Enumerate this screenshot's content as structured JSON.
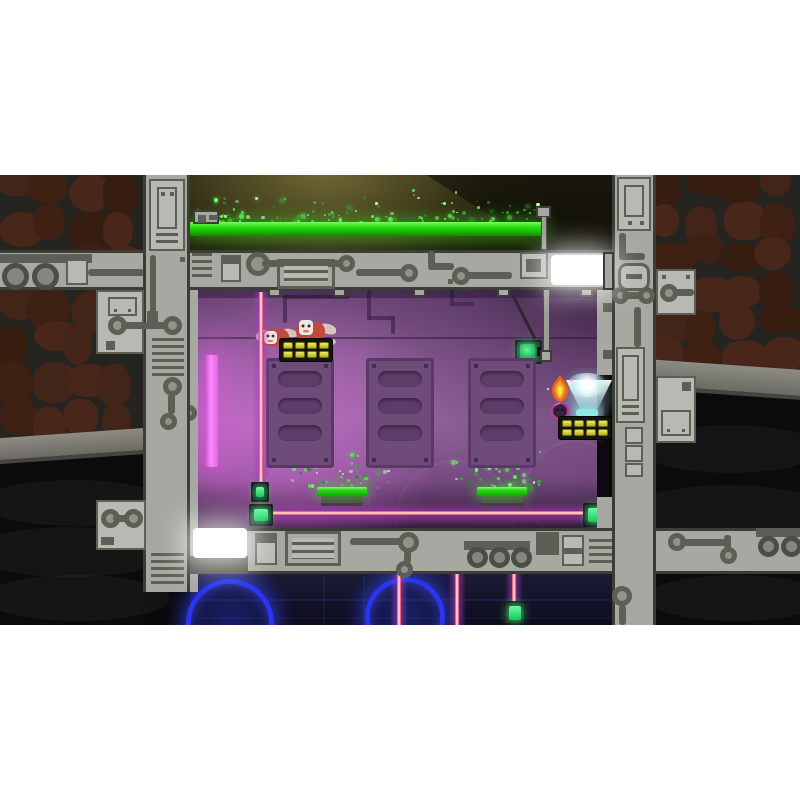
{
  "meta": {
    "app": "2d-platformer-game-screenshot",
    "scene_name": "purple-lab-room",
    "visible_text": "none",
    "letterbox_color": "#ffffff"
  },
  "palette": {
    "frame": "#a6a8a1",
    "frame_light": "#b7b9b2",
    "frame_dark": "#3b3d37",
    "trace": "#5c5f55",
    "rock": "#3f2113",
    "rock_bg": "#262421",
    "cave_black": "#0b0b0b",
    "ledge": "#82817a",
    "grass": "#22d512",
    "grass_hi": "#62f14c",
    "grass_dark": "#0e9b06",
    "cabinet": "#6f4b79",
    "cabinet_dark": "#593a66",
    "magenta": "#e865ea",
    "laser_red": "#e23b52",
    "laser_glow": "rgba(168,58,188,0.5)",
    "yellow": "#d8d435",
    "yellow_hi": "#f0ec6e",
    "block_bg": "#15150c",
    "emit_green": "#2fe56e",
    "beacon": "#9ef2ea",
    "ring_blue": "#2a35f0",
    "flame1": "#e4661c",
    "flame2": "#f59d22",
    "flame3": "#fbe049",
    "ball": "#35223c",
    "ball_rim": "#bb3aa0",
    "critter": "#c24840",
    "critter_face": "#ece7e2",
    "wing": "#d6c4be",
    "white_lamp": "#ffffff"
  },
  "scene": {
    "top": {
      "grass_platform": {
        "x": 190,
        "y": 47,
        "w": 355,
        "h": 14
      },
      "pole": {
        "x": 541,
        "y": 41,
        "w": 6,
        "h": 34,
        "cap_x": 536,
        "cap_y": 31,
        "cap_w": 15,
        "cap_h": 12
      },
      "machine": {
        "x": 193,
        "y": 35,
        "w": 26,
        "h": 14
      },
      "particles": [
        {
          "x": 192,
          "y": 12,
          "w": 350,
          "h": 36,
          "count": 130,
          "seed": 11,
          "bias": 2.4
        },
        {
          "x": 196,
          "y": 34,
          "w": 34,
          "h": 12,
          "count": 14,
          "seed": 4,
          "bias": 1.2
        }
      ]
    },
    "room": {
      "cabinet_y": 183,
      "cabinet_slots": 3,
      "cabinets": [
        {
          "x": 266
        },
        {
          "x": 366
        },
        {
          "x": 468
        }
      ],
      "yellow_platforms": [
        {
          "x": 279,
          "y": 163,
          "cols": 4,
          "rows": 2
        },
        {
          "x": 558,
          "y": 241,
          "cols": 4,
          "rows": 2
        }
      ],
      "green_platforms": [
        {
          "x": 317,
          "y": 312,
          "w": 50
        },
        {
          "x": 477,
          "y": 312,
          "w": 50
        }
      ],
      "particles": [
        {
          "x": 288,
          "y": 276,
          "w": 104,
          "h": 36,
          "count": 44,
          "seed": 5,
          "bias": 1.9
        },
        {
          "x": 438,
          "y": 268,
          "w": 102,
          "h": 44,
          "count": 50,
          "seed": 9,
          "bias": 1.9
        }
      ],
      "lasers": {
        "vertical": [
          {
            "x": 261,
            "y1": 117,
            "y2": 308
          }
        ],
        "horizontal": [
          {
            "x1": 272,
            "x2": 586,
            "y": 338
          }
        ]
      },
      "emitters": [
        {
          "x": 251,
          "y": 307,
          "w": 18,
          "h": 20
        },
        {
          "x": 249,
          "y": 329,
          "w": 24,
          "h": 22
        },
        {
          "x": 583,
          "y": 328,
          "w": 27,
          "h": 24
        }
      ],
      "player": {
        "x": 545,
        "y": 198,
        "label": "flame-haired ball hero"
      },
      "enemies": {
        "x": 256,
        "y": 142,
        "count": 2,
        "label": "winged red critters"
      },
      "beacon": {
        "x": 576,
        "y": 234,
        "label": "teal light beacon"
      },
      "switch": {
        "x": 515,
        "y": 165,
        "label": "green wall switch on pole"
      },
      "magenta_lamp": {
        "x": 205,
        "y": 180,
        "w": 13,
        "h": 112
      }
    },
    "bottom": {
      "rings": [
        {
          "cx": 230,
          "cy": 448,
          "r": 44
        },
        {
          "cx": 405,
          "cy": 442,
          "r": 40
        }
      ],
      "lasers": [
        {
          "x": 399
        },
        {
          "x": 457
        },
        {
          "x": 514
        }
      ],
      "emitters": [
        {
          "x": 504,
          "y": 426,
          "w": 22,
          "h": 24
        }
      ]
    },
    "lamps": {
      "white_top": {
        "x": 551,
        "y": 80,
        "w": 55,
        "h": 30
      },
      "white_bottom": {
        "x": 193,
        "y": 353,
        "w": 54,
        "h": 30
      }
    }
  }
}
